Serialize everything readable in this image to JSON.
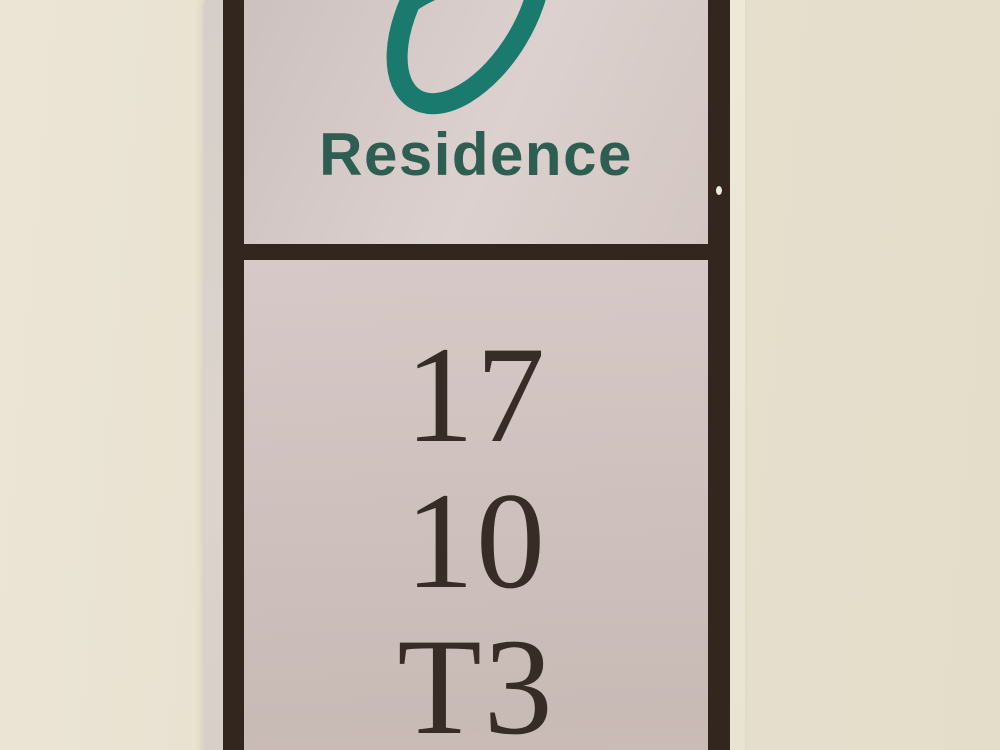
{
  "scene": {
    "description": "Photograph of a wall-mounted residence signage plate"
  },
  "sign": {
    "brand": {
      "logo_icon": "teal-swirl-logo",
      "name": "Residence"
    },
    "unit_lines": [
      "17",
      "10",
      "T3"
    ]
  },
  "colors": {
    "wall": "#e9e2d1",
    "wall-dark": "#e4ddca",
    "face": "#d3c6c3",
    "face-light": "#dcd1ce",
    "face-dark": "#c8bab5",
    "frame": "#33261f",
    "teal": "#1a7a6e",
    "brand-green": "#2e5d51",
    "number-ink": "#372c26",
    "edge-left-1": "#d5cfc9",
    "edge-left-2": "#dcd4cd",
    "edge-right-1": "#eee8d9",
    "edge-right-2": "#e9e3d3",
    "speck": "#eceadf"
  }
}
